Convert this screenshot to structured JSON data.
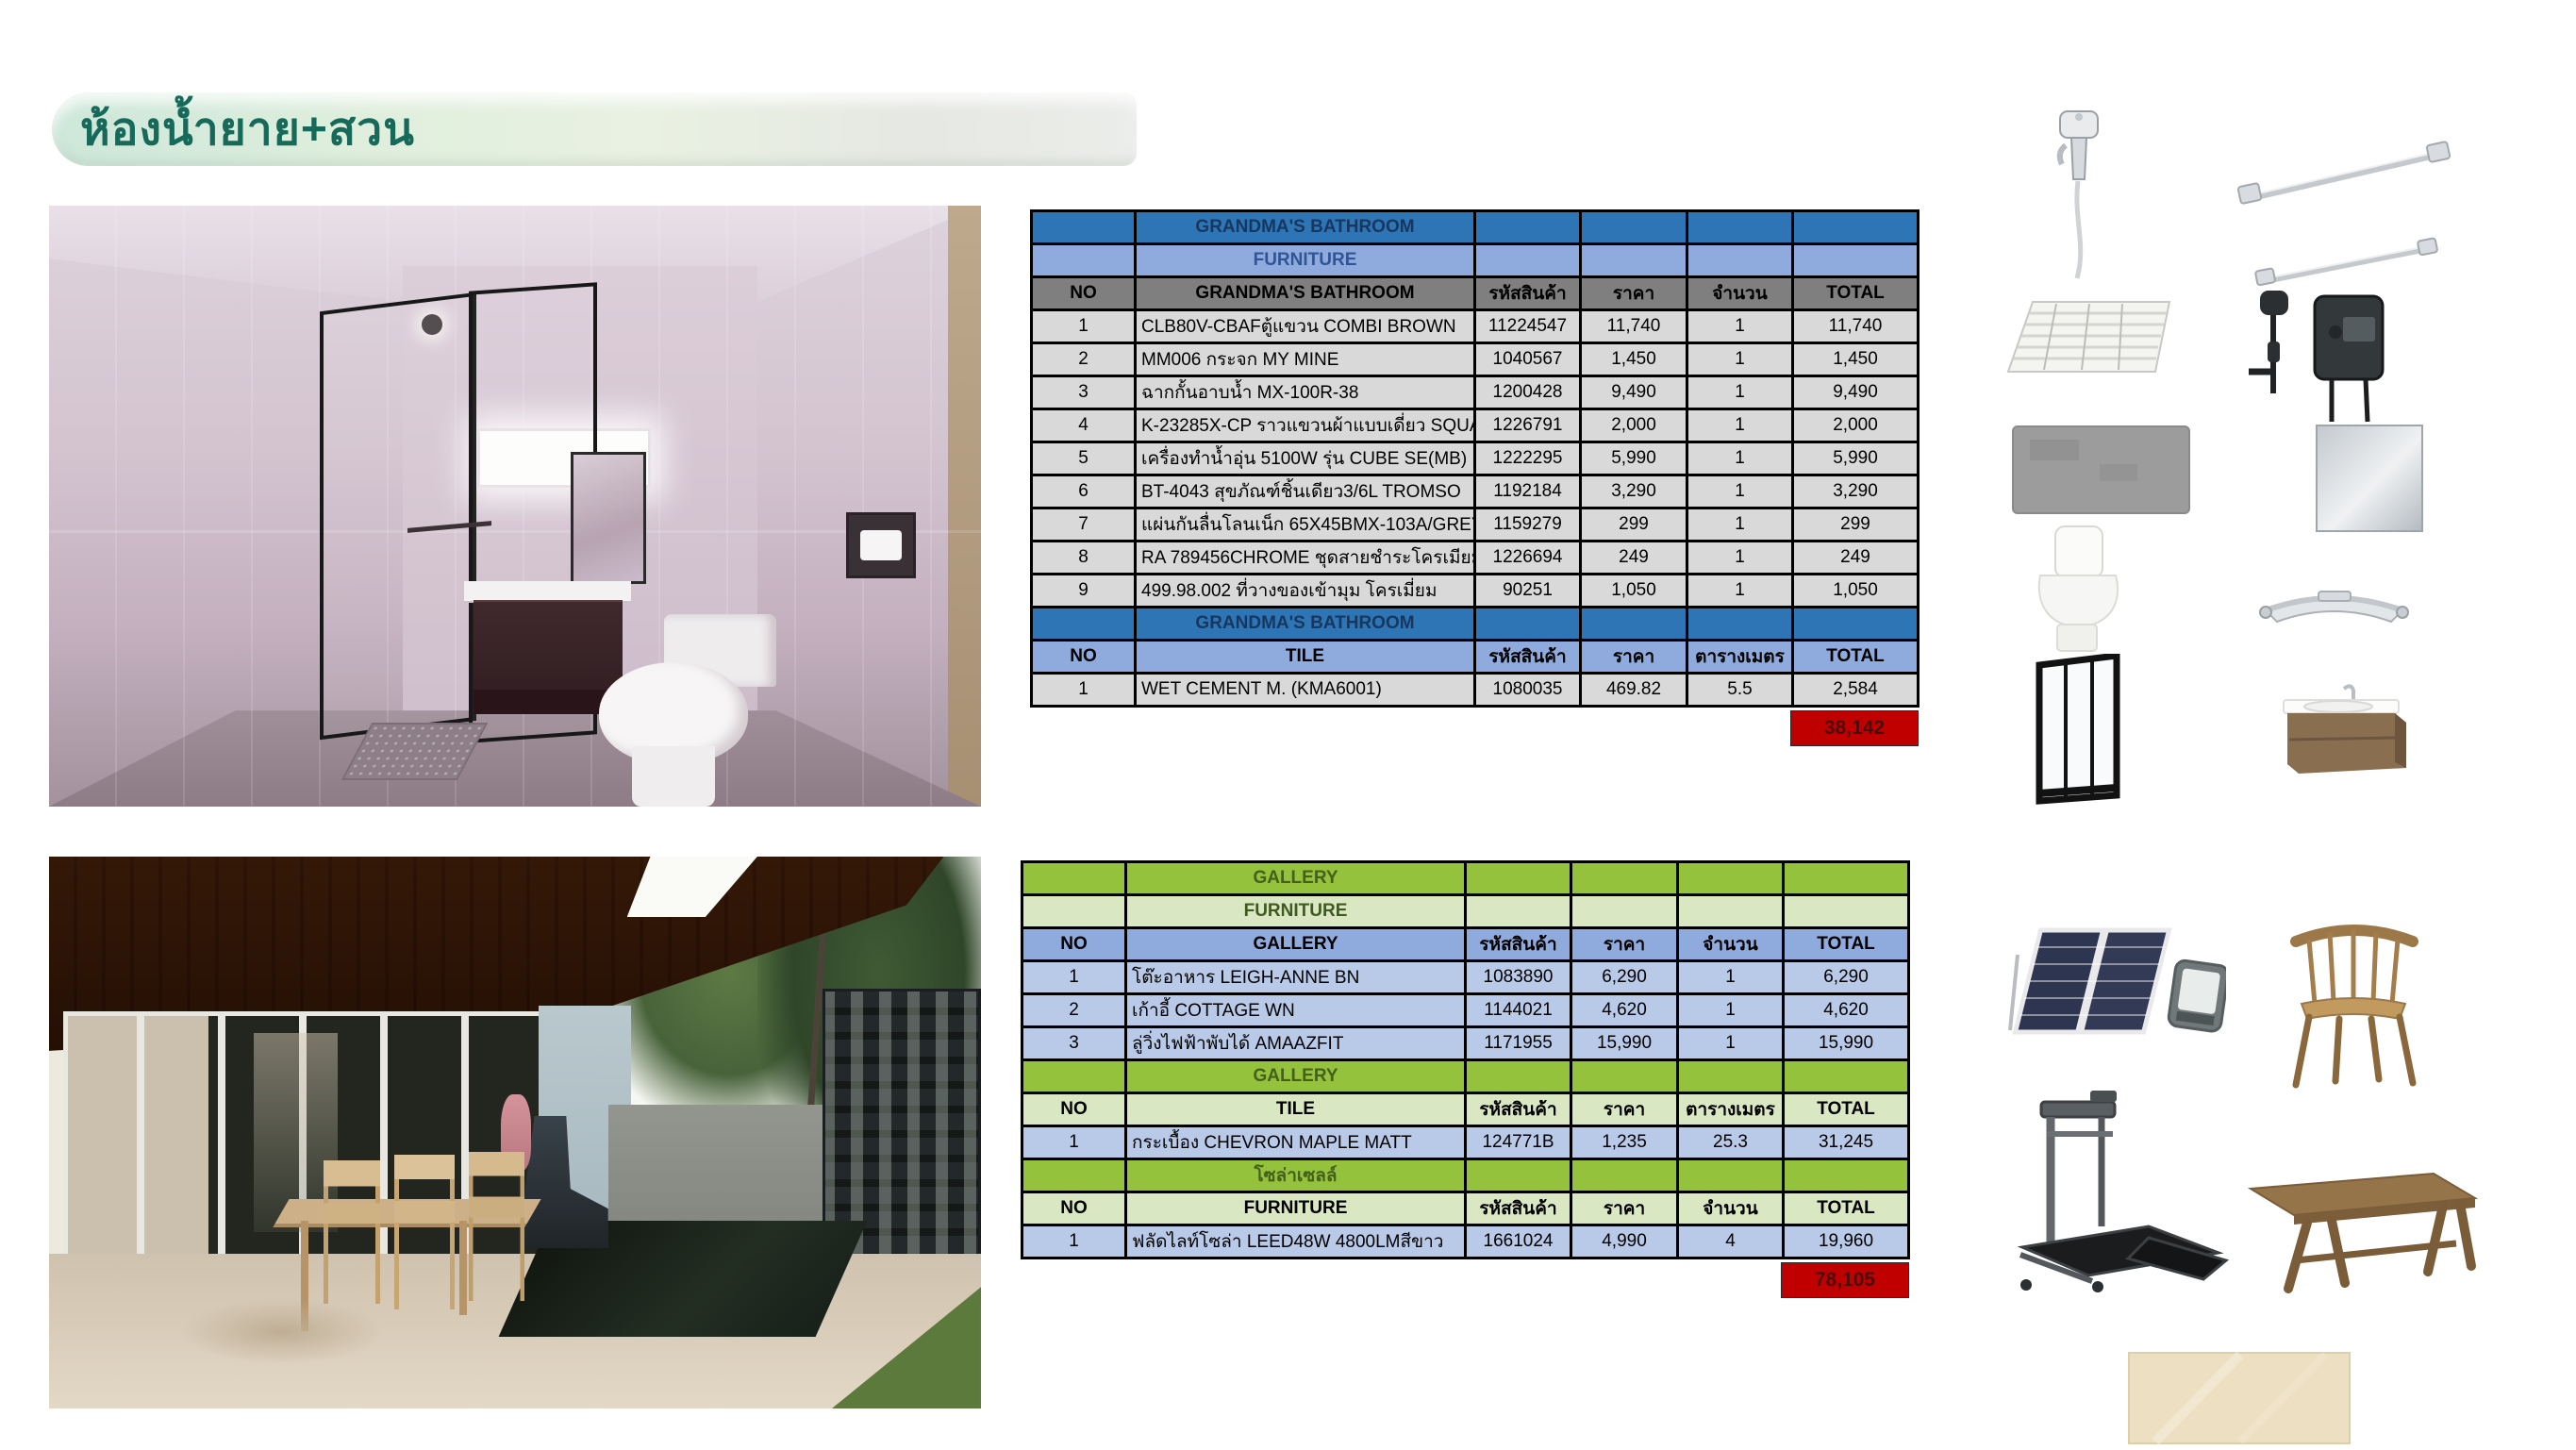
{
  "page": {
    "title": "ห้องน้ำยาย+สวน"
  },
  "colors": {
    "banner_text": "#17695a",
    "table1_section": "#2e75b6",
    "table1_subheader": "#8faadc",
    "table1_colheader": "#7f7f7f",
    "table1_row": "#d9d9d9",
    "table2_section": "#94c23c",
    "table2_subheader": "#d9e7c3",
    "table2_colheader": "#8faadc",
    "table2_row": "#b9c9e8",
    "grand_total_bg": "#c00000"
  },
  "bathroom_table": {
    "rows": [
      {
        "type": "section",
        "cells": [
          "",
          "GRANDMA'S BATHROOM",
          "",
          "",
          "",
          ""
        ]
      },
      {
        "type": "subheader",
        "cells": [
          "",
          "FURNITURE",
          "",
          "",
          "",
          ""
        ]
      },
      {
        "type": "colheader_gray",
        "cells": [
          "NO",
          "GRANDMA'S BATHROOM",
          "รหัสสินค้า",
          "ราคา",
          "จำนวน",
          "TOTAL"
        ]
      },
      {
        "type": "data_gray",
        "cells": [
          "1",
          "CLB80V-CBAFตู้แขวน COMBI BROWN",
          "11224547",
          "11,740",
          "1",
          "11,740"
        ]
      },
      {
        "type": "data_gray",
        "cells": [
          "2",
          "MM006 กระจก MY MINE",
          "1040567",
          "1,450",
          "1",
          "1,450"
        ]
      },
      {
        "type": "data_gray",
        "cells": [
          "3",
          "ฉากกั้นอาบน้ำ MX-100R-38",
          "1200428",
          "9,490",
          "1",
          "9,490"
        ]
      },
      {
        "type": "data_gray",
        "cells": [
          "4",
          "K-23285X-CP ราวแขวนผ้าแบบเดี่ยว SQUARE",
          "1226791",
          "2,000",
          "1",
          "2,000"
        ]
      },
      {
        "type": "data_gray",
        "cells": [
          "5",
          "เครื่องทำน้ำอุ่น 5100W รุ่น CUBE SE(MB)",
          "1222295",
          "5,990",
          "1",
          "5,990"
        ]
      },
      {
        "type": "data_gray",
        "cells": [
          "6",
          "BT-4043 สุขภัณฑ์ชิ้นเดียว3/6L TROMSO",
          "1192184",
          "3,290",
          "1",
          "3,290"
        ]
      },
      {
        "type": "data_gray",
        "cells": [
          "7",
          "แผ่นกันลื่นโลนเน็ก 65X45BMX-103A/GREY",
          "1159279",
          "299",
          "1",
          "299"
        ]
      },
      {
        "type": "data_gray",
        "cells": [
          "8",
          "RA 789456CHROME ชุดสายชำระโครเมียม",
          "1226694",
          "249",
          "1",
          "249"
        ]
      },
      {
        "type": "data_gray",
        "cells": [
          "9",
          "499.98.002 ที่วางของเข้ามุม โครเมี่ยม",
          "90251",
          "1,050",
          "1",
          "1,050"
        ]
      },
      {
        "type": "section",
        "cells": [
          "",
          "GRANDMA'S BATHROOM",
          "",
          "",
          "",
          ""
        ]
      },
      {
        "type": "colheader_blue",
        "cells": [
          "NO",
          "TILE",
          "รหัสสินค้า",
          "ราคา",
          "ตารางเมตร",
          "TOTAL"
        ]
      },
      {
        "type": "data_gray",
        "cells": [
          "1",
          "WET CEMENT M. (KMA6001)",
          "1080035",
          "469.82",
          "5.5",
          "2,584"
        ]
      }
    ],
    "grand_total": "38,142"
  },
  "gallery_table": {
    "rows": [
      {
        "type": "section_green",
        "cells": [
          "",
          "GALLERY",
          "",
          "",
          "",
          ""
        ]
      },
      {
        "type": "subheader_green",
        "cells": [
          "",
          "FURNITURE",
          "",
          "",
          "",
          ""
        ]
      },
      {
        "type": "colheader_peri",
        "cells": [
          "NO",
          "GALLERY",
          "รหัสสินค้า",
          "ราคา",
          "จำนวน",
          "TOTAL"
        ]
      },
      {
        "type": "data_peri",
        "cells": [
          "1",
          "โต๊ะอาหาร LEIGH-ANNE BN",
          "1083890",
          "6,290",
          "1",
          "6,290"
        ]
      },
      {
        "type": "data_peri",
        "cells": [
          "2",
          "เก้าอี้ COTTAGE WN",
          "1144021",
          "4,620",
          "1",
          "4,620"
        ]
      },
      {
        "type": "data_peri",
        "cells": [
          "3",
          "ลู่วิ่งไฟฟ้าพับได้ AMAAZFIT",
          "1171955",
          "15,990",
          "1",
          "15,990"
        ]
      },
      {
        "type": "section_green",
        "cells": [
          "",
          "GALLERY",
          "",
          "",
          "",
          ""
        ]
      },
      {
        "type": "colheader_lightgreen",
        "cells": [
          "NO",
          "TILE",
          "รหัสสินค้า",
          "ราคา",
          "ตารางเมตร",
          "TOTAL"
        ]
      },
      {
        "type": "data_peri",
        "cells": [
          "1",
          "กระเบื้อง CHEVRON MAPLE MATT",
          "124771B",
          "1,235",
          "25.3",
          "31,245"
        ]
      },
      {
        "type": "section_green",
        "cells": [
          "",
          "โซล่าเซลล์",
          "",
          "",
          "",
          ""
        ]
      },
      {
        "type": "colheader_lightgreen",
        "cells": [
          "NO",
          "FURNITURE",
          "รหัสสินค้า",
          "ราคา",
          "จำนวน",
          "TOTAL"
        ]
      },
      {
        "type": "data_peri",
        "cells": [
          "1",
          "ฟลัดไลท์โซล่า LEED48W 4800LMสีขาว",
          "1661024",
          "4,990",
          "4",
          "19,960"
        ]
      }
    ],
    "grand_total": "78,105"
  },
  "renders": [
    {
      "name": "grandmas-bathroom-render"
    },
    {
      "name": "gallery-garden-render"
    }
  ],
  "product_icons": {
    "bathroom": [
      "bidet-spray",
      "towel-bar-long",
      "towel-bar-short",
      "drain-mat",
      "water-heater",
      "gray-bath-mat",
      "mirror",
      "one-piece-toilet",
      "corner-shelf",
      "shower-partition",
      "vanity-cabinet"
    ],
    "garden": [
      "solar-panel-floodlight",
      "wooden-chair",
      "folding-treadmill",
      "wooden-table",
      "beige-tile"
    ]
  }
}
